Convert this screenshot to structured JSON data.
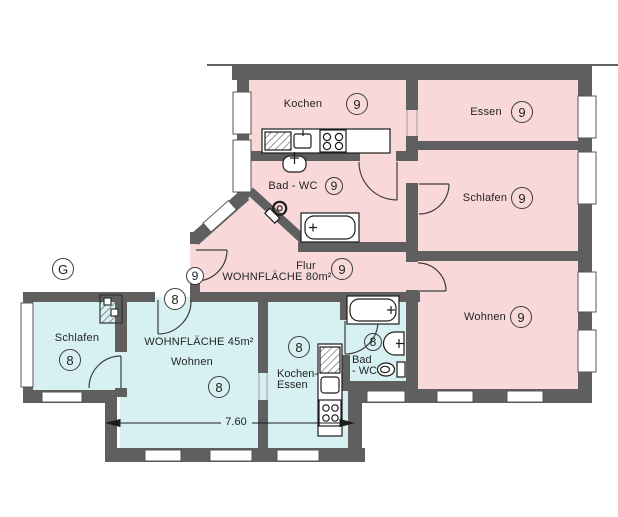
{
  "plan": {
    "colors": {
      "wall": "#5f5f5f",
      "apartment80_fill": "#f8d8d9",
      "apartment45_fill": "#d7f1f3",
      "fixture_stroke": "#1c1c1c",
      "label_color": "#242424"
    },
    "stairwell": {
      "badge": "G"
    },
    "dimension": {
      "label": "7.60"
    },
    "apartment80": {
      "area_label": "WOHNFLÄCHE 80m²",
      "entrance_badge": "9",
      "rooms": {
        "kochen": {
          "label": "Kochen",
          "badge": "9"
        },
        "essen": {
          "label": "Essen",
          "badge": "9"
        },
        "bad_wc": {
          "label": "Bad - WC",
          "badge": "9"
        },
        "schlafen": {
          "label": "Schlafen",
          "badge": "9"
        },
        "flur": {
          "label": "Flur",
          "badge": "9"
        },
        "wohnen": {
          "label": "Wohnen",
          "badge": "9"
        }
      }
    },
    "apartment45": {
      "area_label": "WOHNFLÄCHE 45m²",
      "entrance_badge": "8",
      "rooms": {
        "schlafen": {
          "label": "Schlafen",
          "badge": "8"
        },
        "wohnen": {
          "label": "Wohnen",
          "badge": "8"
        },
        "kochen_essen": {
          "label_line1": "Kochen-",
          "label_line2": "Essen",
          "badge": "8"
        },
        "bad_wc": {
          "label_line1": "Bad",
          "label_line2": "- WC",
          "badge": "8"
        }
      }
    }
  }
}
